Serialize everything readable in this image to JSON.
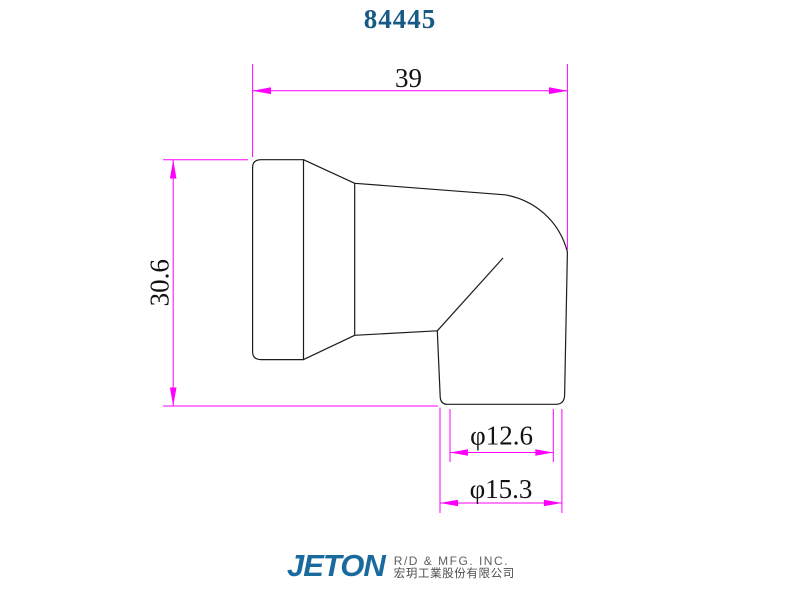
{
  "title": "84445",
  "dimensions": {
    "width": "39",
    "height": "30.6",
    "inner_dia": "φ12.6",
    "outer_dia": "φ15.3"
  },
  "colors": {
    "dimension_line": "#ff00ff",
    "part_outline": "#1c1c1c",
    "title_text": "#175a85",
    "logo_blue": "#1a6b9d",
    "dimension_text": "#121212"
  },
  "footer": {
    "logo": "JETON",
    "company_en": "R/D & MFG. INC.",
    "company_zh": "宏玥工業股份有限公司"
  }
}
